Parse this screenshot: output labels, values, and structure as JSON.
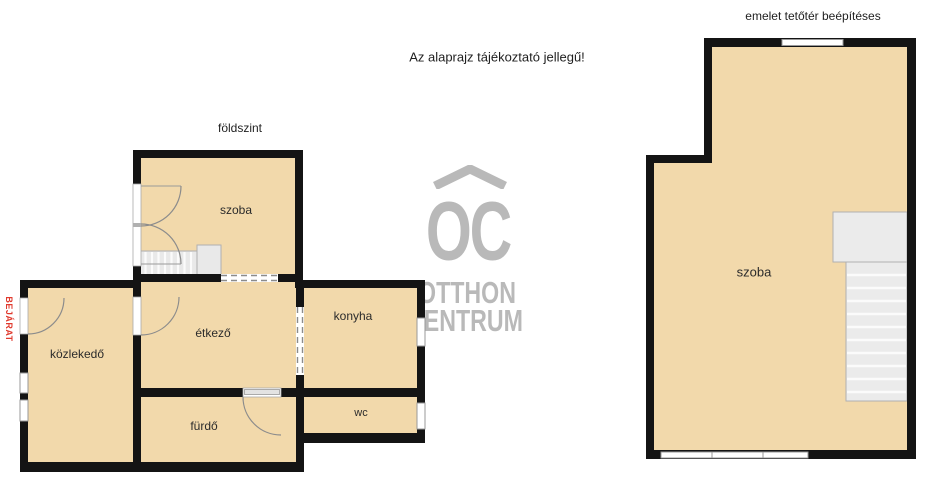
{
  "notice": "Az alaprajz tájékoztató jellegű!",
  "ground_floor": {
    "title": "földszint",
    "entrance_label": "BEJÁRAT",
    "rooms": {
      "szoba": "szoba",
      "etkezo": "étkező",
      "konyha": "konyha",
      "kozlekedo": "közlekedő",
      "furdo": "fürdő",
      "wc": "wc"
    }
  },
  "upper_floor": {
    "title": "emelet tetőtér beépítéses",
    "rooms": {
      "szoba": "szoba"
    }
  },
  "watermark": {
    "monogram": "OC",
    "name_line1": "OTTHON",
    "name_line2": "CENTRUM",
    "roof_icon": "chevron-roof"
  },
  "colors": {
    "floor": "#f2d9ab",
    "wall": "#141414",
    "stairs_fill": "#e9e9e9",
    "stairs_edge": "#b0b0b0",
    "window_frame": "#999999",
    "entrance_red": "#e03a2e",
    "watermark_gray": "#b9b9b9"
  }
}
